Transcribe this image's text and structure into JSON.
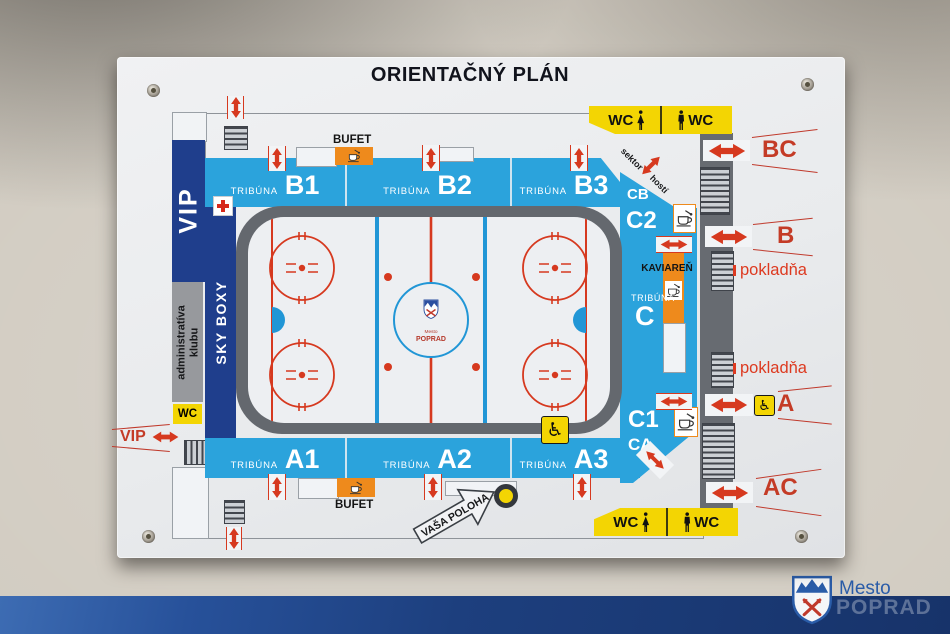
{
  "title": "ORIENTAČNÝ PLÁN",
  "labels": {
    "tribuna": "TRIBÚNA",
    "bufet": "BUFET",
    "kaviaren": "KAVIAREŇ",
    "pokladna": "pokladňa",
    "wc": "WC",
    "vip": "VIP",
    "sky_boxy": "SKY BOXY",
    "administrativa_1": "administratíva",
    "administrativa_2": "klubu",
    "sektor": "sektor",
    "hosti": "hostí",
    "vasa_poloha": "VAŠA POLOHA"
  },
  "stands": {
    "b1": "B1",
    "b2": "B2",
    "b3": "B3",
    "a1": "A1",
    "a2": "A2",
    "a3": "A3",
    "c": "C"
  },
  "sections": {
    "cb": "CB",
    "c2": "C2",
    "c1": "C1",
    "ca": "CA"
  },
  "exits": {
    "bc": "BC",
    "b": "B",
    "a": "A",
    "ac": "AC"
  },
  "icons": {
    "wheelchair": "♿"
  },
  "rink_logo": {
    "top": "Mesto",
    "bottom": "POPRAD"
  },
  "footer": {
    "mesto": "Mesto",
    "poprad": "POPRAD"
  },
  "colors": {
    "stand_blue": "#2ba3dc",
    "navy": "#1f3e8c",
    "wall_gray": "#676b71",
    "accent_red": "#d6391f",
    "exit_red": "#c43b26",
    "orange": "#ee8a1c",
    "yellow": "#f3d503",
    "panel": "#ebedef",
    "strip_navy": "#1d3f7e"
  }
}
